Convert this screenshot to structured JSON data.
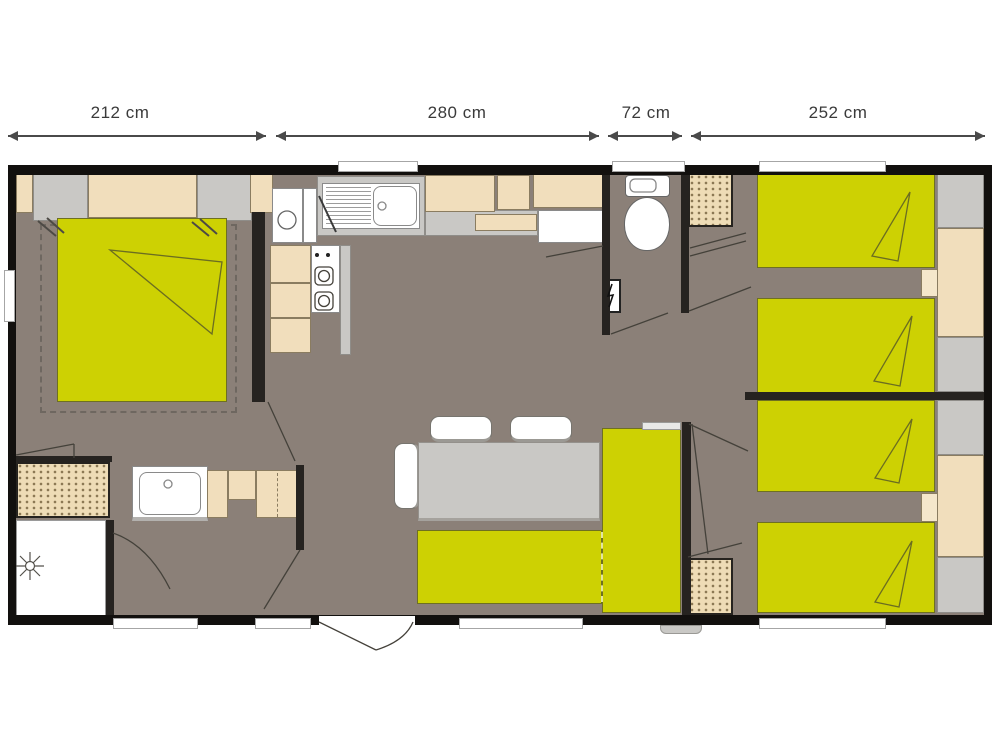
{
  "dimensions": [
    {
      "label": "212 cm"
    },
    {
      "label": "280 cm"
    },
    {
      "label": "72 cm"
    },
    {
      "label": "252 cm"
    }
  ],
  "colors": {
    "bg": "#ffffff",
    "floor": "#8b8078",
    "wall": "#12100e",
    "innerwall": "#262320",
    "bed": "#cdd103",
    "beige": "#f1debc",
    "grayfurn": "#c9c8c5",
    "white": "#ffffff",
    "dimtext": "#3a3a3a"
  }
}
